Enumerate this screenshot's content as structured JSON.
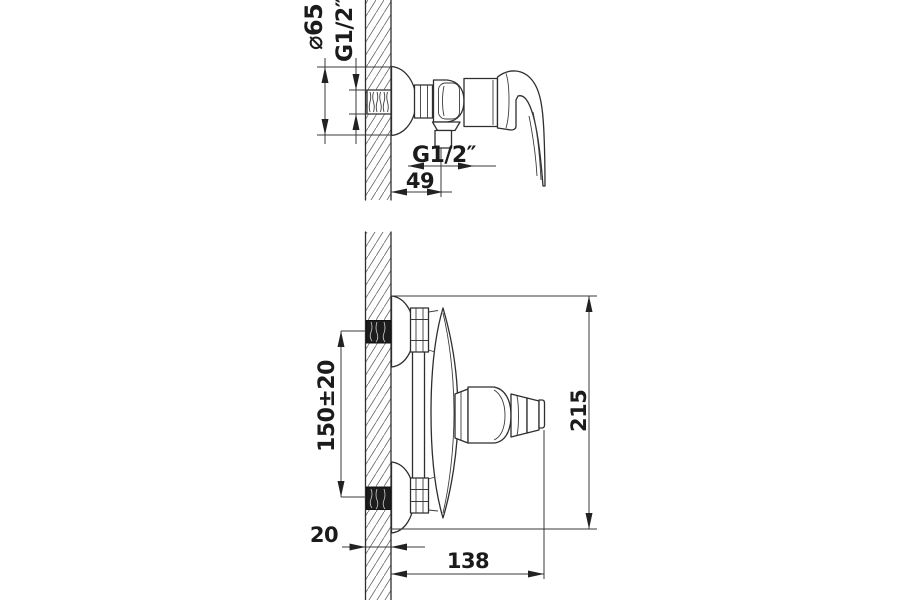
{
  "drawing": {
    "background": "#ffffff",
    "line_color": "#2e2e2e",
    "text_color": "#1b1b1b",
    "side_view": {
      "escutcheon_diameter_label": "⌀65",
      "wall_thread_label": "G1/2″",
      "outlet_thread_label": "G1/2″",
      "outlet_offset_label": "49"
    },
    "mounting_view": {
      "inlet_spacing_label": "150±20",
      "overall_span_label": "215",
      "wall_thickness_label": "20",
      "projection_label": "138"
    }
  }
}
